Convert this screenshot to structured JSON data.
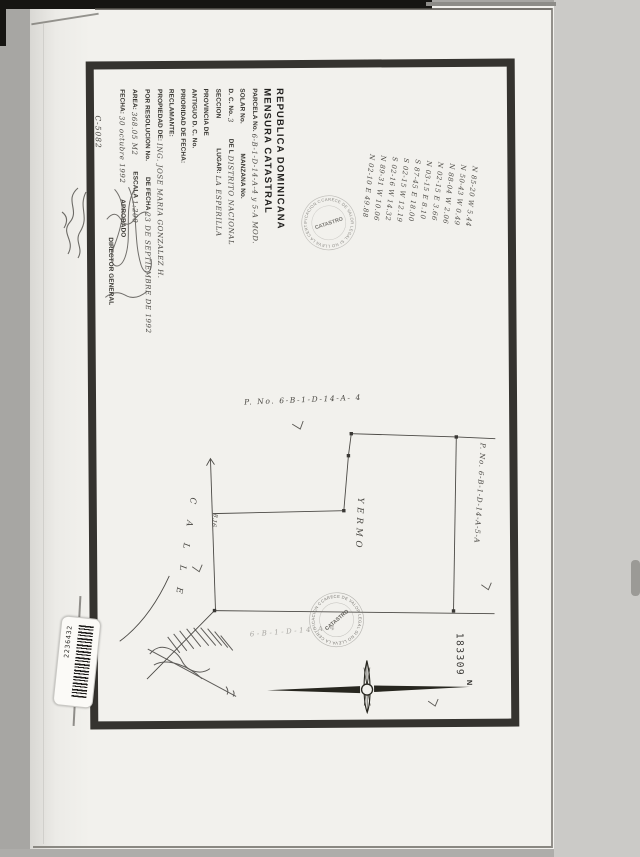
{
  "document": {
    "title_line1": "REPUBLICA DOMINICANA",
    "title_line2": "MENSURA CATASTRAL"
  },
  "form": {
    "parcela_label": "PARCELA No.",
    "parcela_value": "6-B-1-D-14-A-4 y 5-A MOD.",
    "solar_label": "SOLAR No.",
    "manzana_label": "MANZANA No.",
    "dc_label": "D. C. No.",
    "dc_value": "3",
    "de_la_label": "DE L",
    "dc_place_value": "DISTRITO NACIONAL",
    "seccion_label": "SECCION",
    "lugar_label": "LUGAR:",
    "lugar_value": "LA ESPERILLA",
    "provincia_label": "PROVINCIA DE",
    "antiguo_dc_label": "ANTIGUO D. C. No.",
    "prioridad_label": "PRIORIDAD DE FECHA:",
    "reclamante_label": "RECLAMANTE:",
    "propiedad_label": "PROPIEDAD DE:",
    "propiedad_value": "ING. JOSE MARIA GONZALEZ H.",
    "resolucion_label": "POR RESOLUCION No.",
    "de_fecha_label": "DE FECHA",
    "resolucion_fecha_value": "23 DE SEPTIEMBRE DE 1992",
    "area_label": "AREA:",
    "area_value": "368.05 M2",
    "escala_label": "ESCALA",
    "escala_value": "1:200",
    "fecha_label": "FECHA:",
    "fecha_value": "30 octubre 1992",
    "aprobado_label": "APROBADO",
    "director_label": "DIRECTOR GENERAL",
    "code_value": "C-5082"
  },
  "bearings": {
    "lines": [
      "N 85-20 W   5.44",
      "N 50-43 W   0.49",
      "N 88-04 W   2.06",
      "N 02-15 E   3.66",
      "N 03-15 E   8.10",
      "S 87-45 E  18.00",
      "S 02-15 W  12.19",
      "S 02-16 W  14.32",
      "N 89-31 W  10.06",
      "N 02-10 E  49.88"
    ]
  },
  "plat": {
    "parcel_label": "P. No. 6-B-1-D-14-A- 4",
    "neighbor_parcel_label": "P. No. 6-B-1-D-14-A-5-A",
    "street_label": "C A L L E",
    "land_label": "YERMO",
    "side_note": "8.16",
    "under_stamp_note": "6-B-1-D-14-A-4",
    "north_label": "N",
    "sheet_number": "183309"
  },
  "stamp": {
    "ring_text": "CARECE DE VALOR LEGAL SI NO LLEVA LA CERTIFICACION CORRESPONDIENTE",
    "center_text": "CATASTRO"
  },
  "sticker": {
    "barcode_number": "2236432"
  }
}
